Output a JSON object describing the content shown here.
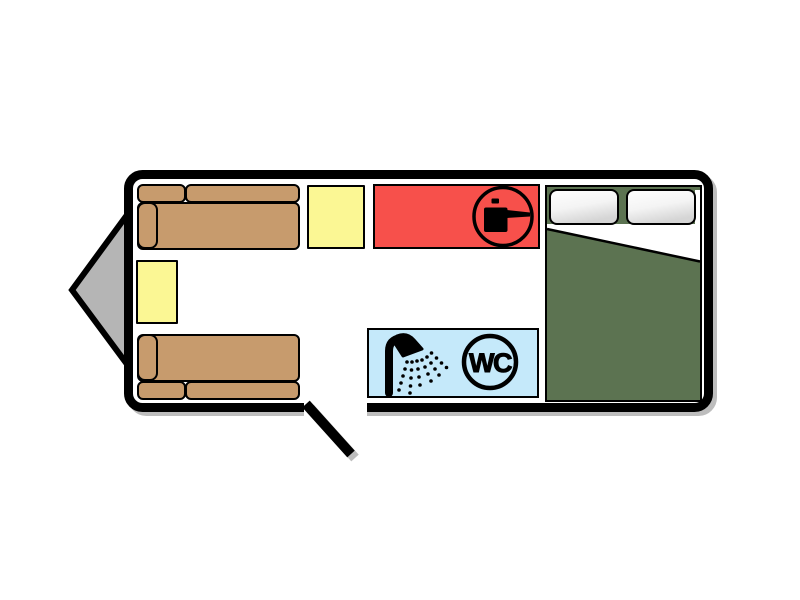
{
  "diagram": {
    "type": "caravan floor plan",
    "canvas_background": "#ffffff",
    "outline_color": "#000000",
    "shadow_color": "#bdbdbd",
    "hitch": {
      "label": "tow hitch drawbar",
      "color": "#b5b5b5",
      "position": "left"
    },
    "door": {
      "label": "entrance door opening",
      "wall": "bottom",
      "state": "open, swing shown at 45 degrees"
    },
    "lounge": {
      "sofas": [
        {
          "label": "front sofa top",
          "color": "#c79b6d",
          "parts": [
            "armrest",
            "seat",
            "backrest-left",
            "backrest-right"
          ]
        },
        {
          "label": "front sofa bottom",
          "color": "#c79b6d",
          "parts": [
            "armrest",
            "seat",
            "backrest-left",
            "backrest-right"
          ]
        }
      ],
      "cabinets": [
        {
          "label": "top cabinet",
          "color": "#fbf794"
        },
        {
          "label": "front cabinet",
          "color": "#fbf794"
        }
      ]
    },
    "kitchen": {
      "label": "kitchen unit",
      "color": "#f7504b",
      "icon": "cooking-pot-icon"
    },
    "bathroom": {
      "label": "washroom",
      "color": "#c5e9fa",
      "shower_icon": "shower-icon",
      "wc_label": "WC"
    },
    "bedroom": {
      "label": "fixed double bed",
      "color": "#5c7351",
      "pillow_count": 2,
      "pillow_color": "#ffffff",
      "sheet_color": "#ffffff"
    }
  }
}
